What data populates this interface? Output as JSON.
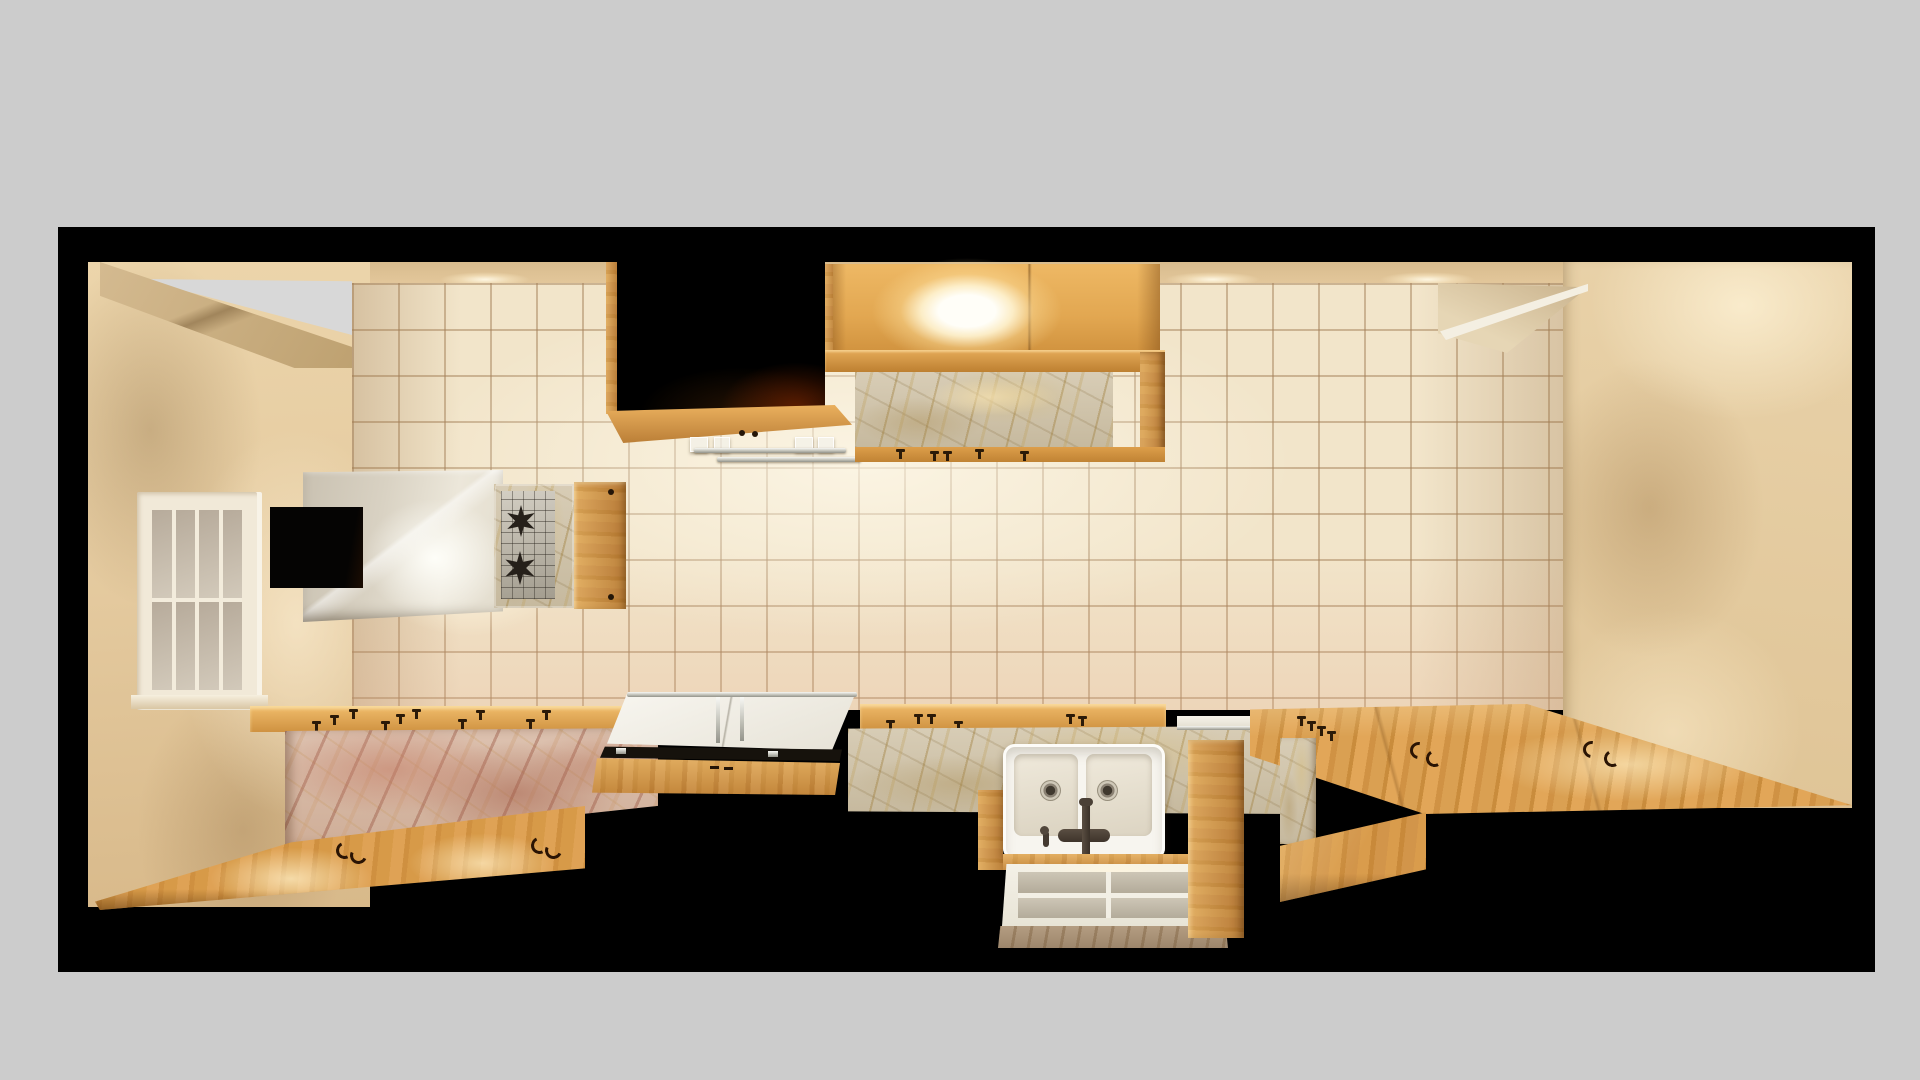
{
  "scene": {
    "type": "rendered-3d-interior",
    "description": "Top-down cutaway (dollhouse style) 3D render of a narrow galley kitchen framed by a thick black wall-section border on a light gray backdrop. No text, UI controls or numbers are visible anywhere in the image.",
    "visible_text": "",
    "view": "elevated plan / section view, warm interior lighting"
  },
  "objects": {
    "backdrop": "light gray page backdrop",
    "frame": "black cut wall section framing the room",
    "ceiling_band": "beige ceiling strip with warm recessed spotlight glows",
    "left_wall": "beige side wall",
    "sloped_ceiling": "sloped ceiling plane in top-left corner",
    "sky_gap": "gray opening above sloped ceiling",
    "window": "white-framed window with 8 panes (4 x 2) on the left wall",
    "tile_wall": "cream square-tile back wall",
    "right_wall": "beige right wall with soft light and shadow",
    "soffit": "angled soffit plane at top right of tile wall",
    "range_hood": "white box range hood with dark side opening and warm light",
    "cooktop": "two-burner stainless cooktop with black star grates in marble surround",
    "stove_cabinet_door": "small pine cabinet door beside cooktop",
    "dark_void": "black recess above hood with pine trim",
    "hanging_rack": "chrome and glass rail rack hanging below the recess",
    "upper_cabinet": "lit pine upper cabinet with two doors and glowing interior light",
    "upper_cabinet_backsplash": "gold-veined marble panel below upper cabinet with pine rails and pulls",
    "left_counter": "pine counter edge with knob pins and pink-veined marble front panel",
    "lower_left_counter": "lower pine countertop with wire pulls and warm light pools",
    "island": "white glossy-top island cart with chrome rail and pine body",
    "sink_counter": "pine-edged counter with gold marble backsplash",
    "sink": "white ceramic double-basin farmhouse sink with dark bridge faucet",
    "sink_drawer": "white pull-out drying tray with frosted panels below sink",
    "right_counter": "large pine counter landing with curl pulls, pins and step",
    "marble_block": "gold marble end block at right counter step"
  },
  "palette": {
    "backdrop": "#cccccc",
    "frame_black": "#000000",
    "wall_beige": "#e6cda5",
    "wall_shadow": "#c8a878",
    "ceiling_band": "#ddc194",
    "tile": "#f6ecd7",
    "grout": "#b99a6e",
    "wood_mid": "#d89b49",
    "wood_lit": "#f3c178",
    "wood_dark": "#b97f36",
    "marble_pink": "#d5b5a2",
    "marble_pink_vein": "#a4624d",
    "marble_gold": "#cfc3ab",
    "marble_gold_vein": "#a0824a",
    "hood_white": "#e9e3d6",
    "sink_white": "#f7f5ef",
    "chrome": "#d9d9d4",
    "faucet": "#473c33",
    "glass_pane": "#b7ab9b",
    "light_warm": "#ffedc4",
    "void_ember": "#3a1000"
  }
}
